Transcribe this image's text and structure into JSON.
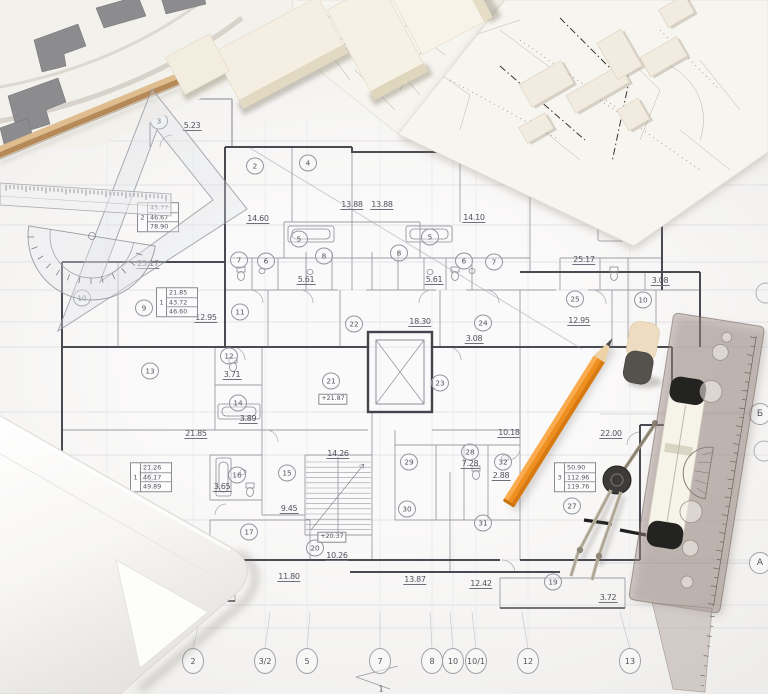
{
  "scene_title": "Architectural floor plan blueprint with drafting tools and building scale models",
  "colors": {
    "pencil_orange": "#ef9125",
    "pencil_wood": "#e9cfa0",
    "graphite": "#44444a",
    "paper": "#f4f3f1",
    "plan_line": "#9d9da6",
    "plan_wall": "#4a4a53",
    "dimension_text": "#53535f",
    "model_cream": "#f2edde",
    "wood_edge": "#d3a979",
    "eraser_cream": "#ecdcc0",
    "eraser_gray": "#55524d",
    "roller_white": "#f6f3e9",
    "compass_metal": "#b9b1a0",
    "site_building_gray": "#8c8c8e"
  },
  "objects": {
    "drawing_tools": [
      "triangle-set-square",
      "transparent-ruler",
      "protractor",
      "orange-pencil",
      "divider-compass",
      "rolling-parallel-ruler",
      "eraser",
      "paper-roll",
      "wooden-edge"
    ],
    "models": [
      "building-model-blocks",
      "site-model-board"
    ],
    "sheets": [
      "site-plan-sheet",
      "detail-drawing-sheet",
      "floor-plan-sheet"
    ]
  },
  "floor_plan": {
    "room_numbers": [
      {
        "n": "3",
        "x": 159,
        "y": 121
      },
      {
        "n": "2",
        "x": 255,
        "y": 166
      },
      {
        "n": "4",
        "x": 308,
        "y": 163
      },
      {
        "n": "5",
        "x": 299,
        "y": 239
      },
      {
        "n": "5",
        "x": 430,
        "y": 237
      },
      {
        "n": "7",
        "x": 239,
        "y": 260
      },
      {
        "n": "6",
        "x": 266,
        "y": 261
      },
      {
        "n": "8",
        "x": 324,
        "y": 256
      },
      {
        "n": "8",
        "x": 399,
        "y": 253
      },
      {
        "n": "6",
        "x": 464,
        "y": 261
      },
      {
        "n": "7",
        "x": 494,
        "y": 262
      },
      {
        "n": "9",
        "x": 144,
        "y": 308
      },
      {
        "n": "10",
        "x": 82,
        "y": 298
      },
      {
        "n": "11",
        "x": 240,
        "y": 312
      },
      {
        "n": "22",
        "x": 354,
        "y": 324
      },
      {
        "n": "24",
        "x": 483,
        "y": 323
      },
      {
        "n": "25",
        "x": 575,
        "y": 299
      },
      {
        "n": "10",
        "x": 643,
        "y": 300
      },
      {
        "n": "12",
        "x": 229,
        "y": 356
      },
      {
        "n": "13",
        "x": 150,
        "y": 371
      },
      {
        "n": "14",
        "x": 238,
        "y": 403
      },
      {
        "n": "21",
        "x": 331,
        "y": 381
      },
      {
        "n": "23",
        "x": 440,
        "y": 383
      },
      {
        "n": "18",
        "x": 148,
        "y": 473
      },
      {
        "n": "16",
        "x": 237,
        "y": 475
      },
      {
        "n": "15",
        "x": 287,
        "y": 473
      },
      {
        "n": "17",
        "x": 249,
        "y": 532
      },
      {
        "n": "20",
        "x": 315,
        "y": 548
      },
      {
        "n": "19",
        "x": 159,
        "y": 583
      },
      {
        "n": "29",
        "x": 409,
        "y": 462
      },
      {
        "n": "28",
        "x": 470,
        "y": 452
      },
      {
        "n": "32",
        "x": 503,
        "y": 462
      },
      {
        "n": "30",
        "x": 407,
        "y": 509
      },
      {
        "n": "31",
        "x": 483,
        "y": 523
      },
      {
        "n": "27",
        "x": 572,
        "y": 506
      },
      {
        "n": "19",
        "x": 553,
        "y": 582
      }
    ],
    "dimensions": [
      {
        "t": "5.23",
        "x": 192,
        "y": 126
      },
      {
        "t": "14.60",
        "x": 258,
        "y": 219
      },
      {
        "t": "13.88",
        "x": 352,
        "y": 205
      },
      {
        "t": "13.88",
        "x": 382,
        "y": 205
      },
      {
        "t": "14.10",
        "x": 474,
        "y": 218
      },
      {
        "t": "5.61",
        "x": 306,
        "y": 280
      },
      {
        "t": "5.61",
        "x": 434,
        "y": 280
      },
      {
        "t": "25.17",
        "x": 148,
        "y": 264
      },
      {
        "t": "25.17",
        "x": 584,
        "y": 260
      },
      {
        "t": "3.08",
        "x": 660,
        "y": 281
      },
      {
        "t": "3.08",
        "x": 474,
        "y": 339
      },
      {
        "t": "12.95",
        "x": 206,
        "y": 318
      },
      {
        "t": "12.95",
        "x": 579,
        "y": 321
      },
      {
        "t": "18.30",
        "x": 420,
        "y": 322
      },
      {
        "t": "3.71",
        "x": 232,
        "y": 375
      },
      {
        "t": "3.89",
        "x": 248,
        "y": 419
      },
      {
        "t": "21.85",
        "x": 196,
        "y": 434
      },
      {
        "t": "14.26",
        "x": 338,
        "y": 454
      },
      {
        "t": "3.65",
        "x": 222,
        "y": 487
      },
      {
        "t": "9.45",
        "x": 289,
        "y": 509
      },
      {
        "t": "21.26",
        "x": 181,
        "y": 532
      },
      {
        "t": "10.26",
        "x": 337,
        "y": 556
      },
      {
        "t": "11.80",
        "x": 289,
        "y": 577
      },
      {
        "t": "3.72",
        "x": 173,
        "y": 592
      },
      {
        "t": "10.18",
        "x": 509,
        "y": 433
      },
      {
        "t": "7.28",
        "x": 470,
        "y": 464
      },
      {
        "t": "2.88",
        "x": 501,
        "y": 476
      },
      {
        "t": "22.00",
        "x": 611,
        "y": 434
      },
      {
        "t": "13.87",
        "x": 415,
        "y": 580
      },
      {
        "t": "12.42",
        "x": 481,
        "y": 584
      },
      {
        "t": "3.72",
        "x": 608,
        "y": 598
      }
    ],
    "area_tables": [
      {
        "label": "1",
        "rows": [
          "21.85",
          "43.72",
          "46.60"
        ],
        "x": 177,
        "y": 302
      },
      {
        "label": "2",
        "rows": [
          "45.77",
          "46.67",
          "78.90"
        ],
        "x": 158,
        "y": 217
      },
      {
        "label": "1",
        "rows": [
          "21.26",
          "46.17",
          "49.89"
        ],
        "x": 151,
        "y": 477
      },
      {
        "label": "3",
        "rows": [
          "50.90",
          "112.96",
          "119.76"
        ],
        "x": 575,
        "y": 477
      }
    ],
    "elevation_marks": [
      {
        "t": "+21.87",
        "x": 333,
        "y": 399
      },
      {
        "t": "+20.37",
        "x": 332,
        "y": 537
      }
    ],
    "grid_columns_y": 661,
    "grid_columns": [
      {
        "label": "1",
        "x": 107
      },
      {
        "label": "2",
        "x": 193
      },
      {
        "label": "3/2",
        "x": 265
      },
      {
        "label": "5",
        "x": 307
      },
      {
        "label": "7",
        "x": 380
      },
      {
        "label": "8",
        "x": 432
      },
      {
        "label": "10",
        "x": 453
      },
      {
        "label": "10/1",
        "x": 476
      },
      {
        "label": "12",
        "x": 528
      },
      {
        "label": "13",
        "x": 630
      }
    ],
    "grid_rows_x": 760,
    "grid_rows": [
      {
        "label": "Б",
        "y": 414
      },
      {
        "label": "А",
        "y": 563
      }
    ],
    "annotations": [
      {
        "t": "1",
        "x": 381,
        "y": 689
      }
    ]
  }
}
